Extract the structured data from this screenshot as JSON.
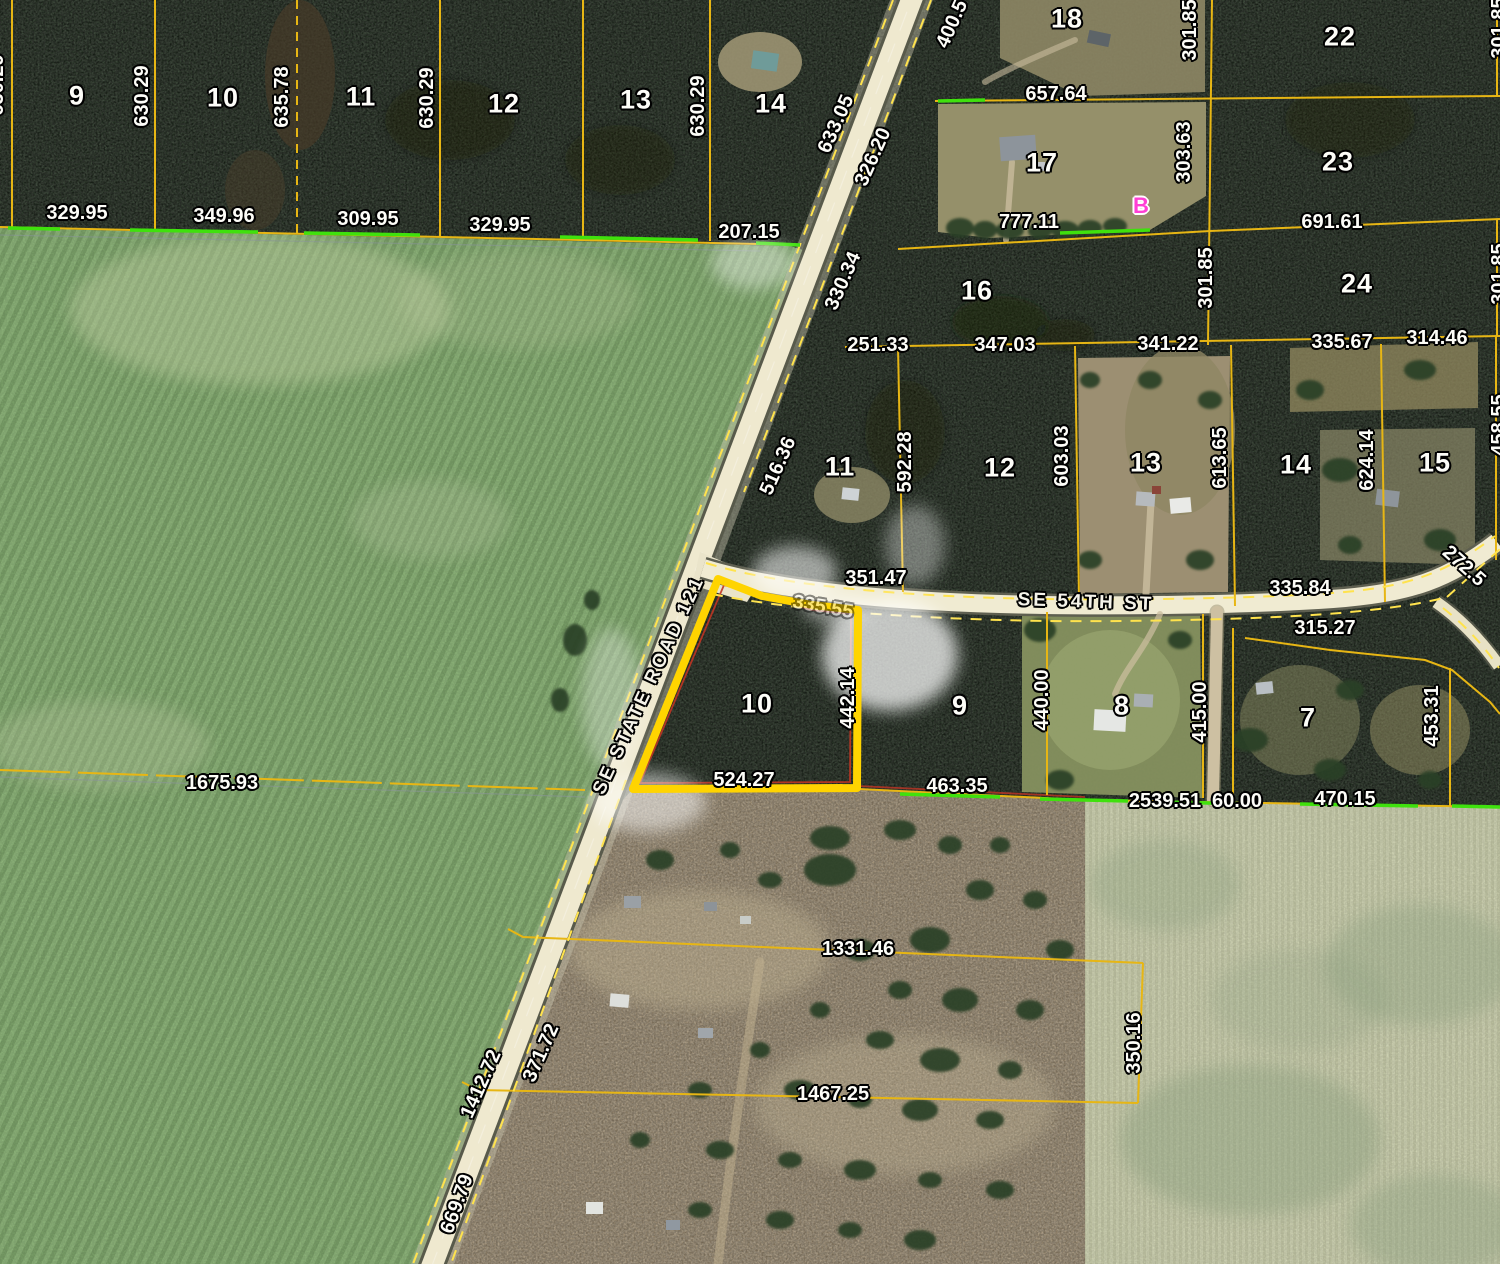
{
  "map": {
    "description": "aerial-parcel-map",
    "colors": {
      "highlight_outline": "#FFD400",
      "parcel_line": "#E7B614",
      "survey_tick_green": "#3FE10D",
      "marker_magenta": "#FF3FD4",
      "label_text": "#FDFDF8"
    },
    "roads": [
      {
        "name": "SE STATE ROAD 121"
      },
      {
        "name": "SE 54TH ST"
      }
    ],
    "labels": [
      {
        "t": "9",
        "x": 77,
        "y": 96,
        "k": "lot"
      },
      {
        "t": "10",
        "x": 223,
        "y": 98,
        "k": "lot"
      },
      {
        "t": "11",
        "x": 361,
        "y": 97,
        "k": "lot"
      },
      {
        "t": "12",
        "x": 504,
        "y": 104,
        "k": "lot"
      },
      {
        "t": "13",
        "x": 636,
        "y": 100,
        "k": "lot"
      },
      {
        "t": "14",
        "x": 771,
        "y": 104,
        "k": "lot"
      },
      {
        "t": "18",
        "x": 1067,
        "y": 19,
        "k": "lot"
      },
      {
        "t": "22",
        "x": 1340,
        "y": 37,
        "k": "lot"
      },
      {
        "t": "17",
        "x": 1042,
        "y": 163,
        "k": "lot"
      },
      {
        "t": "23",
        "x": 1338,
        "y": 162,
        "k": "lot"
      },
      {
        "t": "16",
        "x": 977,
        "y": 291,
        "k": "lot"
      },
      {
        "t": "24",
        "x": 1357,
        "y": 284,
        "k": "lot"
      },
      {
        "t": "11",
        "x": 840,
        "y": 467,
        "k": "lot"
      },
      {
        "t": "12",
        "x": 1000,
        "y": 468,
        "k": "lot"
      },
      {
        "t": "13",
        "x": 1146,
        "y": 463,
        "k": "lot"
      },
      {
        "t": "14",
        "x": 1296,
        "y": 465,
        "k": "lot"
      },
      {
        "t": "15",
        "x": 1435,
        "y": 463,
        "k": "lot"
      },
      {
        "t": "10",
        "x": 757,
        "y": 704,
        "k": "lot"
      },
      {
        "t": "9",
        "x": 960,
        "y": 706,
        "k": "lot"
      },
      {
        "t": "8",
        "x": 1122,
        "y": 706,
        "k": "lot"
      },
      {
        "t": "7",
        "x": 1308,
        "y": 718,
        "k": "lot"
      },
      {
        "t": "329.95",
        "x": 77,
        "y": 213,
        "k": "dim"
      },
      {
        "t": "349.96",
        "x": 224,
        "y": 216,
        "k": "dim"
      },
      {
        "t": "309.95",
        "x": 368,
        "y": 219,
        "k": "dim"
      },
      {
        "t": "329.95",
        "x": 500,
        "y": 225,
        "k": "dim"
      },
      {
        "t": "207.15",
        "x": 749,
        "y": 232,
        "k": "dim"
      },
      {
        "t": "630.29",
        "x": 142,
        "y": 96,
        "r": -90,
        "k": "dim"
      },
      {
        "t": "635.78",
        "x": 282,
        "y": 97,
        "r": -90,
        "k": "dim"
      },
      {
        "t": "630.29",
        "x": 427,
        "y": 98,
        "r": -90,
        "k": "dim"
      },
      {
        "t": "630.29",
        "x": 698,
        "y": 106,
        "r": -90,
        "k": "dim"
      },
      {
        "t": "630.29",
        "x": -3,
        "y": 85,
        "r": -90,
        "k": "dim"
      },
      {
        "t": "633.05",
        "x": 836,
        "y": 124,
        "r": -66,
        "k": "dim"
      },
      {
        "t": "326.20",
        "x": 873,
        "y": 157,
        "r": -66,
        "k": "dim"
      },
      {
        "t": "400.5",
        "x": 952,
        "y": 24,
        "r": -66,
        "k": "dim"
      },
      {
        "t": "657.64",
        "x": 1056,
        "y": 94,
        "k": "dim"
      },
      {
        "t": "777.11",
        "x": 1029,
        "y": 222,
        "k": "dim"
      },
      {
        "t": "691.61",
        "x": 1332,
        "y": 222,
        "k": "dim"
      },
      {
        "t": "301.85",
        "x": 1190,
        "y": 30,
        "r": -90,
        "k": "dim"
      },
      {
        "t": "303.63",
        "x": 1184,
        "y": 152,
        "r": -90,
        "k": "dim"
      },
      {
        "t": "301.85",
        "x": 1206,
        "y": 278,
        "r": -90,
        "k": "dim"
      },
      {
        "t": "301.85",
        "x": 1499,
        "y": 28,
        "r": -90,
        "k": "dim"
      },
      {
        "t": "301.85",
        "x": 1499,
        "y": 274,
        "r": -90,
        "k": "dim"
      },
      {
        "t": "330.34",
        "x": 843,
        "y": 281,
        "r": -66,
        "k": "dim"
      },
      {
        "t": "251.33",
        "x": 878,
        "y": 345,
        "k": "dim"
      },
      {
        "t": "347.03",
        "x": 1005,
        "y": 345,
        "k": "dim"
      },
      {
        "t": "341.22",
        "x": 1168,
        "y": 344,
        "k": "dim"
      },
      {
        "t": "335.67",
        "x": 1342,
        "y": 342,
        "k": "dim"
      },
      {
        "t": "314.46",
        "x": 1437,
        "y": 338,
        "k": "dim"
      },
      {
        "t": "592.28",
        "x": 905,
        "y": 462,
        "r": -90,
        "k": "dim"
      },
      {
        "t": "603.03",
        "x": 1062,
        "y": 456,
        "r": -90,
        "k": "dim"
      },
      {
        "t": "613.65",
        "x": 1220,
        "y": 458,
        "r": -90,
        "k": "dim"
      },
      {
        "t": "624.14",
        "x": 1367,
        "y": 460,
        "r": -90,
        "k": "dim"
      },
      {
        "t": "458.55",
        "x": 1499,
        "y": 425,
        "r": -90,
        "k": "dim"
      },
      {
        "t": "516.36",
        "x": 778,
        "y": 466,
        "r": -66,
        "k": "dim"
      },
      {
        "t": "351.47",
        "x": 876,
        "y": 578,
        "k": "dim"
      },
      {
        "t": "335.84",
        "x": 1300,
        "y": 588,
        "k": "dim"
      },
      {
        "t": "315.27",
        "x": 1325,
        "y": 628,
        "k": "dim"
      },
      {
        "t": "272.5",
        "x": 1464,
        "y": 566,
        "r": 42,
        "k": "dim"
      },
      {
        "t": "335.55",
        "x": 823,
        "y": 607,
        "r": 10,
        "k": "dimfaint"
      },
      {
        "t": "442.14",
        "x": 848,
        "y": 698,
        "r": -90,
        "k": "dim"
      },
      {
        "t": "440.00",
        "x": 1042,
        "y": 700,
        "r": -90,
        "k": "dim"
      },
      {
        "t": "415.00",
        "x": 1200,
        "y": 712,
        "r": -90,
        "k": "dim"
      },
      {
        "t": "453.31",
        "x": 1432,
        "y": 716,
        "r": -90,
        "k": "dim"
      },
      {
        "t": "524.27",
        "x": 744,
        "y": 780,
        "k": "dim"
      },
      {
        "t": "463.35",
        "x": 957,
        "y": 786,
        "k": "dim"
      },
      {
        "t": "2539.51",
        "x": 1165,
        "y": 801,
        "k": "dim"
      },
      {
        "t": "60.00",
        "x": 1237,
        "y": 801,
        "k": "dim"
      },
      {
        "t": "470.15",
        "x": 1345,
        "y": 799,
        "k": "dim"
      },
      {
        "t": "1675.93",
        "x": 222,
        "y": 783,
        "k": "dim"
      },
      {
        "t": "1331.46",
        "x": 858,
        "y": 949,
        "k": "dim"
      },
      {
        "t": "1467.25",
        "x": 833,
        "y": 1094,
        "k": "dim"
      },
      {
        "t": "350.16",
        "x": 1134,
        "y": 1043,
        "r": -90,
        "k": "dim"
      },
      {
        "t": "1412.72",
        "x": 481,
        "y": 1084,
        "r": -66,
        "k": "dim"
      },
      {
        "t": "371.72",
        "x": 541,
        "y": 1053,
        "r": -66,
        "k": "dim"
      },
      {
        "t": "669.79",
        "x": 457,
        "y": 1204,
        "r": -70,
        "k": "dim"
      },
      {
        "t": "SE STATE ROAD 121",
        "x": 649,
        "y": 685,
        "r": -65,
        "k": "road"
      },
      {
        "t": "SE 54TH ST",
        "x": 1086,
        "y": 602,
        "r": 2,
        "k": "road"
      },
      {
        "t": "B",
        "x": 1141,
        "y": 206,
        "k": "marker"
      }
    ]
  }
}
